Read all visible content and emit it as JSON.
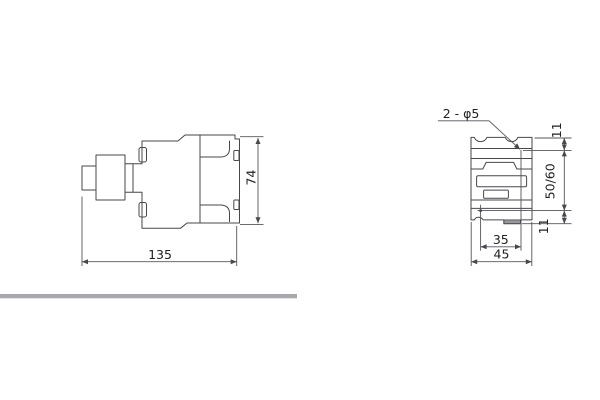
{
  "side_view": {
    "width_label": "135",
    "height_label": "74"
  },
  "front_view": {
    "holes_label": "2 - φ5",
    "top_margin_label": "11",
    "mounting_pitch_label": "50/60",
    "bottom_margin_label": "11",
    "hole_spacing_label": "35",
    "width_label": "45"
  },
  "colors": {
    "line": "#47474d",
    "text": "#222222",
    "divider_bar": "#a9a9ad"
  }
}
